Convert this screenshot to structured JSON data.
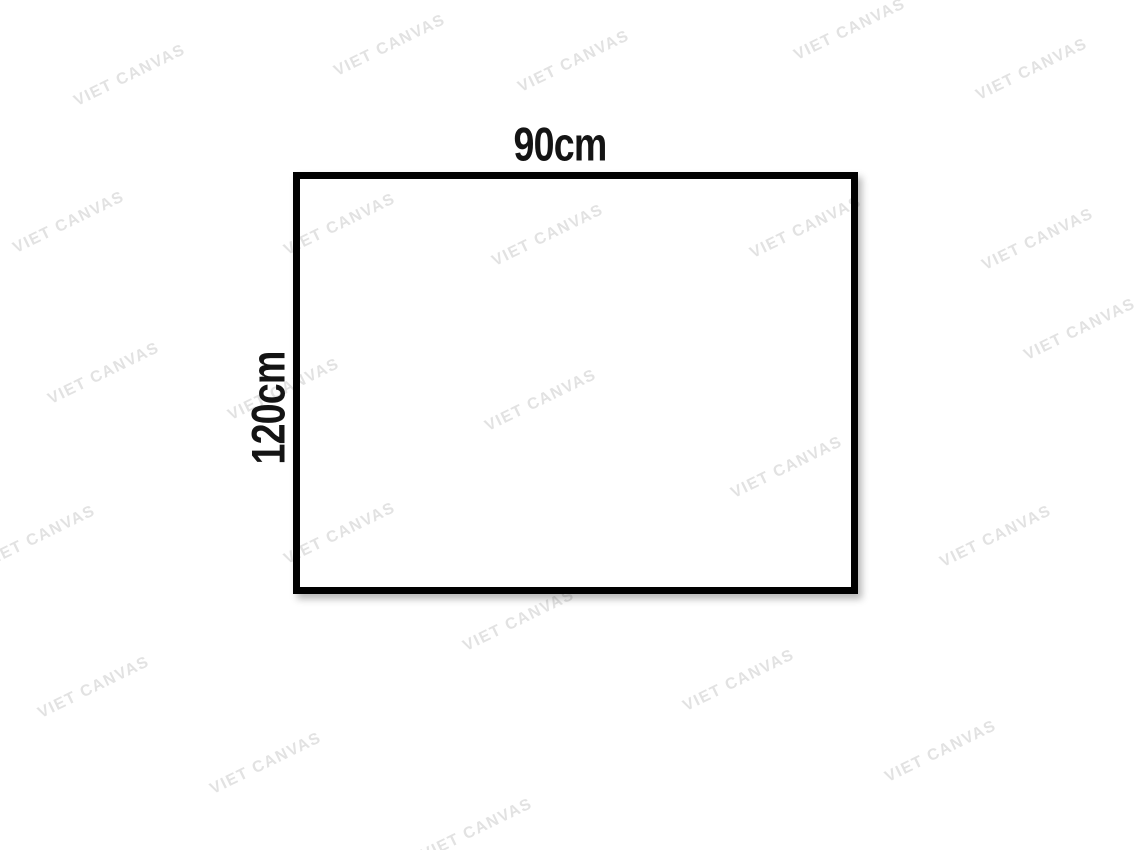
{
  "page": {
    "background_color": "#ffffff"
  },
  "canvas_mockup": {
    "width_label": "90cm",
    "height_label": "120cm",
    "border_color": "#000000",
    "label_color": "#141414"
  },
  "watermark": {
    "text": "VIET CANVAS",
    "color": "#e2e2e2",
    "angle_deg": -26,
    "positions": [
      {
        "x": 130,
        "y": 76
      },
      {
        "x": 390,
        "y": 46
      },
      {
        "x": 574,
        "y": 62
      },
      {
        "x": 850,
        "y": 30
      },
      {
        "x": 1032,
        "y": 70
      },
      {
        "x": 69,
        "y": 223
      },
      {
        "x": 340,
        "y": 225
      },
      {
        "x": 548,
        "y": 236
      },
      {
        "x": 806,
        "y": 228
      },
      {
        "x": 1038,
        "y": 240
      },
      {
        "x": 104,
        "y": 374
      },
      {
        "x": 284,
        "y": 390
      },
      {
        "x": 541,
        "y": 401
      },
      {
        "x": 1080,
        "y": 330
      },
      {
        "x": 40,
        "y": 537
      },
      {
        "x": 340,
        "y": 534
      },
      {
        "x": 787,
        "y": 468
      },
      {
        "x": 996,
        "y": 537
      },
      {
        "x": 519,
        "y": 621
      },
      {
        "x": 94,
        "y": 688
      },
      {
        "x": 739,
        "y": 681
      },
      {
        "x": 266,
        "y": 764
      },
      {
        "x": 941,
        "y": 752
      },
      {
        "x": 477,
        "y": 830
      }
    ]
  }
}
